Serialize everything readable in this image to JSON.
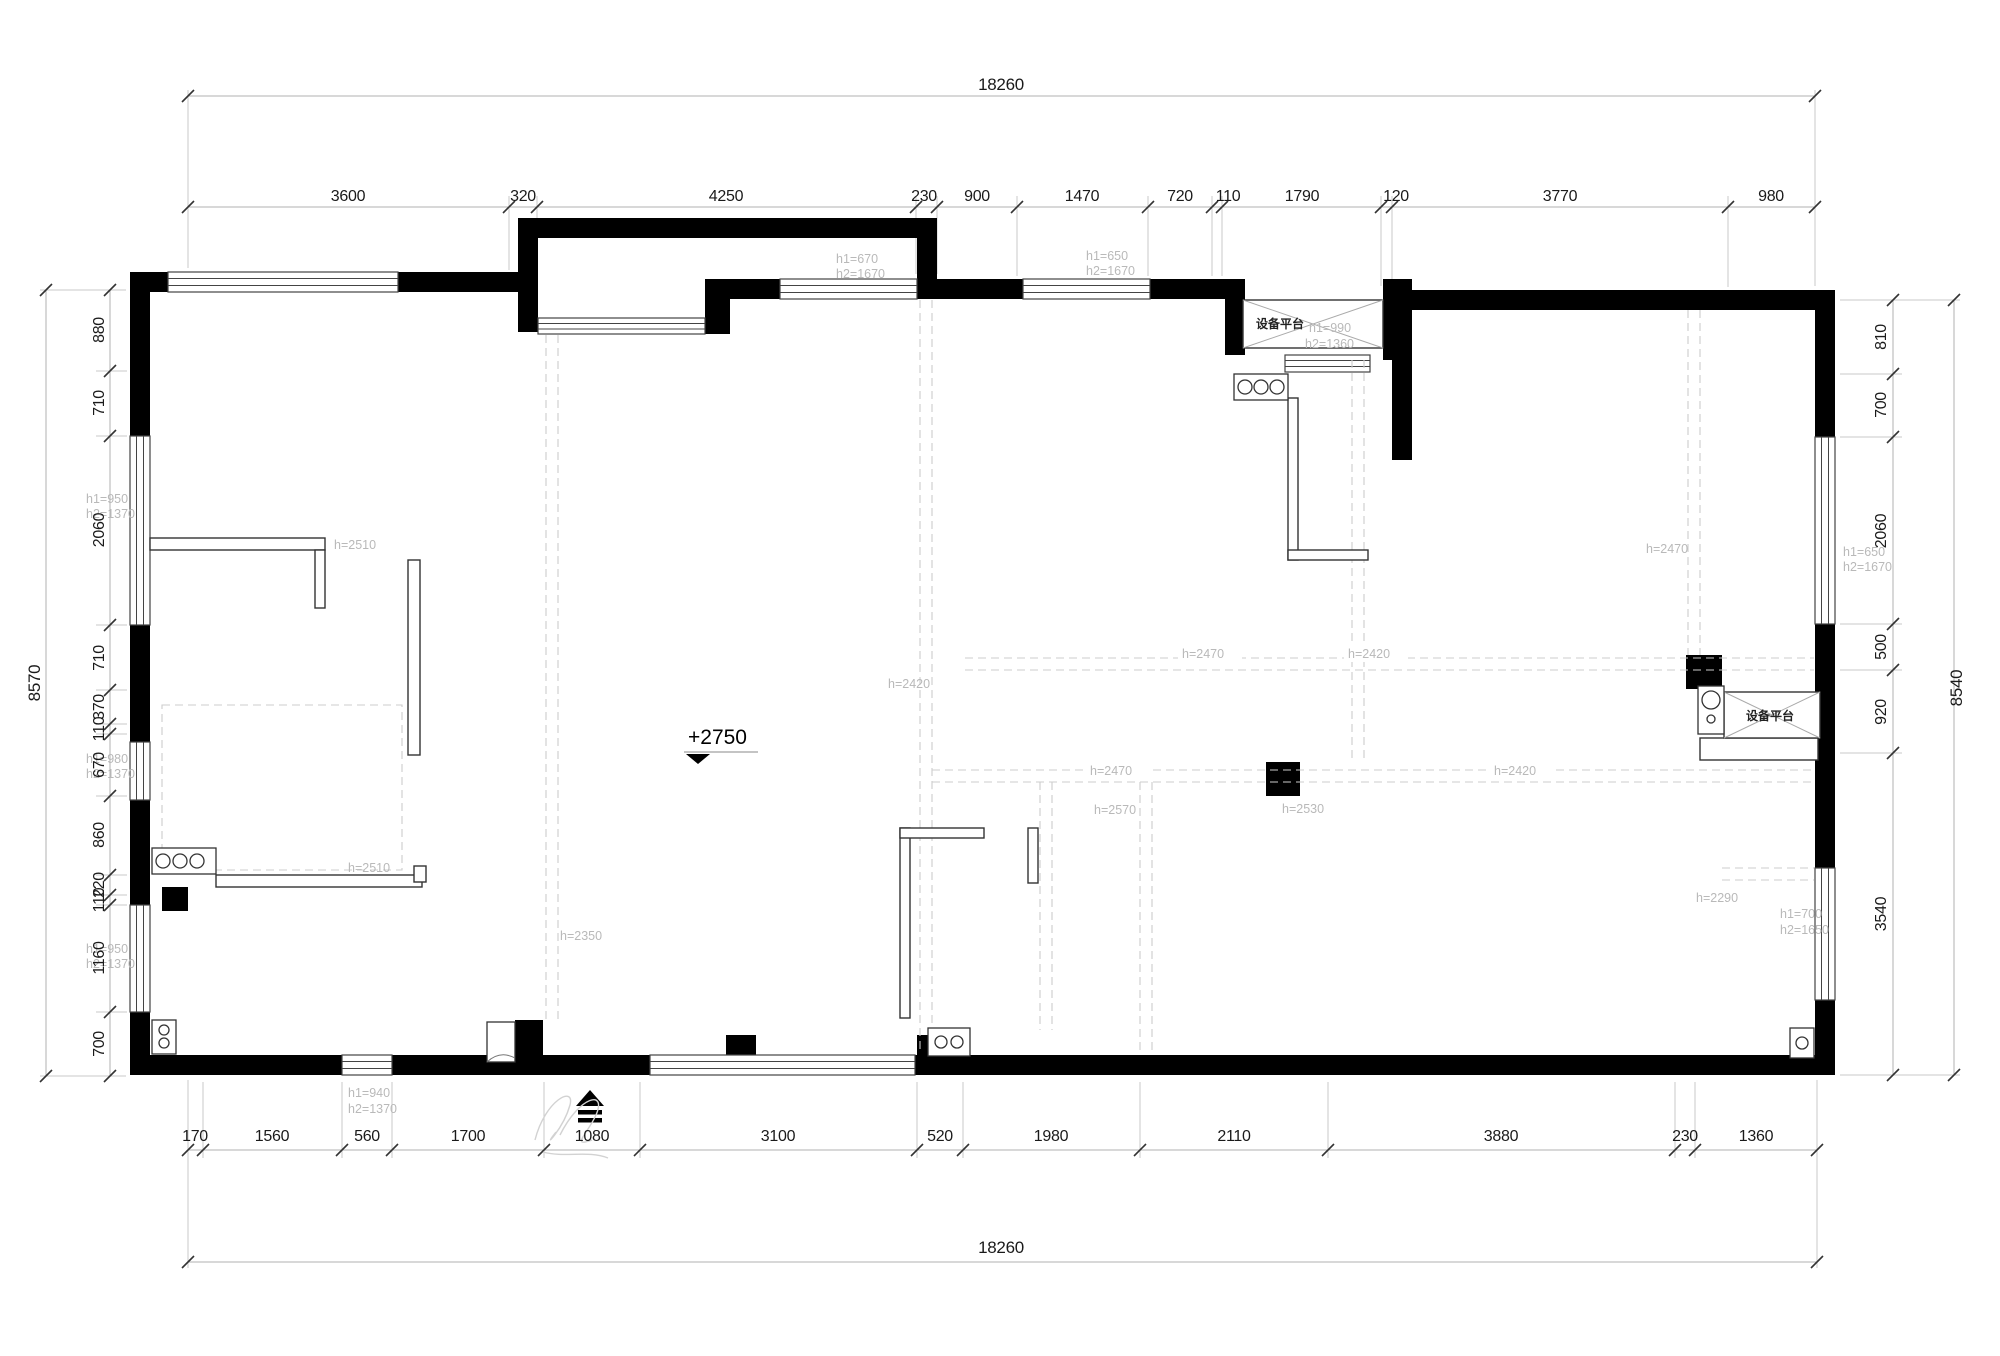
{
  "dims": {
    "top_total": "18260",
    "bottom_total": "18260",
    "left_total": "8570",
    "right_total": "8540",
    "top_chain": [
      "3600",
      "320",
      "4250",
      "230",
      "900",
      "1470",
      "720",
      "110",
      "1790",
      "120",
      "3770",
      "980"
    ],
    "bottom_chain": [
      "170",
      "1560",
      "560",
      "1700",
      "1080",
      "3100",
      "520",
      "1980",
      "2110",
      "3880",
      "230",
      "1360"
    ],
    "left_chain": [
      "880",
      "710",
      "2060",
      "710",
      "370",
      "110",
      "670",
      "860",
      "220",
      "110",
      "1160",
      "700"
    ],
    "right_chain": [
      "810",
      "700",
      "2060",
      "500",
      "920",
      "3540"
    ]
  },
  "labels": {
    "elevation_marker": "+2750",
    "equipment_platform_top": "设备平台",
    "equipment_platform_right": "设备平台",
    "heights": {
      "top_window_left": [
        "h1=670",
        "h2=1670"
      ],
      "top_window_mid": [
        "h1=650",
        "h2=1670"
      ],
      "platform_top": [
        "h1=990",
        "h2=1360"
      ],
      "right_room_top": "h=2470",
      "right_window": [
        "h1=650",
        "h2=1670"
      ],
      "left_window_upper": [
        "h1=950",
        "h2=1370"
      ],
      "left_window_mid": [
        "h1=980",
        "h2=1370"
      ],
      "left_window_lower": [
        "h1=950",
        "h2=1370"
      ],
      "bottom_window": [
        "h1=940",
        "h2=1370"
      ],
      "partition_upper": "h=2510",
      "partition_lower": "h=2510",
      "hall": "h=2350",
      "living_left": "h=2420",
      "dining_top": "h=2470",
      "kitchen_side": "h=2420",
      "beam_left": "h=2470",
      "beam_right": "h=2420",
      "bedroom_mid_left": "h=2570",
      "bedroom_mid_right": "h=2530",
      "bedroom_right": "h=2290",
      "right_window_lower": [
        "h1=700",
        "h2=1650"
      ]
    }
  }
}
